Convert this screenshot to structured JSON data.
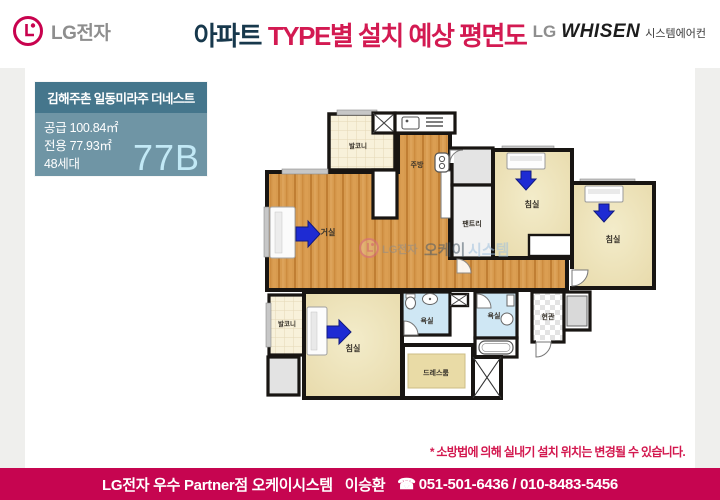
{
  "header": {
    "lg_logo_text": "LG전자",
    "title_dark": "아파트",
    "title_accent": "TYPE별 설치 예상 평면도",
    "whisen": {
      "lg": "LG",
      "brand": "WHISEN",
      "suffix": "시스템에어컨"
    }
  },
  "info_box": {
    "complex_name": "김해주촌 일동미라주 더네스트",
    "supply_area": "공급 100.84㎡",
    "exclusive_area": "전용 77.93㎡",
    "households": "48세대",
    "unit_type": "77B"
  },
  "plan": {
    "labels": {
      "balcony_top": "발코니",
      "kitchen": "주방",
      "living": "거실",
      "pantry": "팬트리",
      "bedroom1": "침실",
      "bedroom2": "침실",
      "bedroom3": "침실",
      "balcony_bottom": "발코니",
      "bath1": "욕실",
      "bath2": "욕실",
      "dressroom": "드레스룸",
      "entrance": "현관"
    },
    "watermark": {
      "lg": "LG전자",
      "part1": "오케이",
      "part2": "시스템"
    }
  },
  "disclaimer": "* 소방법에 의해 실내기 설치 위치는 변경될 수 있습니다.",
  "footer": {
    "partner_label": "LG전자 우수 Partner점 오케이시스템",
    "name": "이승환",
    "phone_icon": "☎",
    "phone": "051-501-6436 / 010-8483-5456"
  },
  "colors": {
    "accent_crimson": "#c60550",
    "title_navy": "#17384c",
    "title_crimson": "#d31a52",
    "info_header_bg": "#45768c",
    "info_body_bg": "#6f95a5",
    "unit_type_text": "#c2e9f6",
    "wood_floor": "#d79a4e",
    "bedroom_floor": "#e7d9a9",
    "balcony_floor": "#f8f1da",
    "bathroom_floor": "#cfe7f4",
    "arrow_blue": "#1e2bd3",
    "wall": "#181512"
  }
}
